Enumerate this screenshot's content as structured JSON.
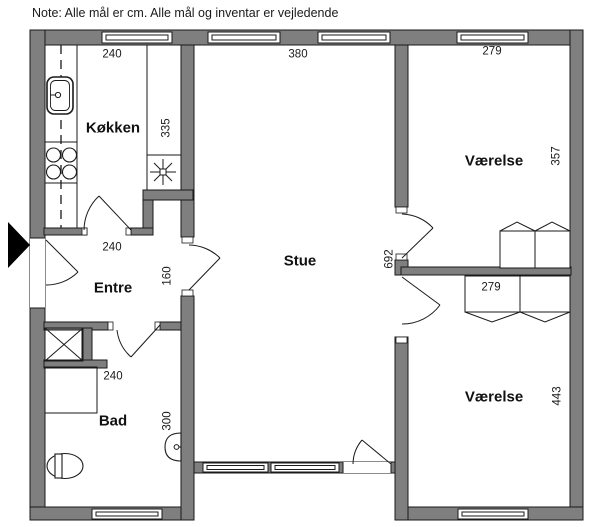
{
  "note": "Note: Alle mål er cm. Alle mål og inventar er vejledende",
  "rooms": {
    "koekken": {
      "label": "Køkken",
      "width_cm": "240",
      "depth_cm": "335"
    },
    "stue": {
      "label": "Stue",
      "width_cm": "380",
      "depth_cm": "692"
    },
    "vaerelse_top": {
      "label": "Værelse",
      "width_cm": "279",
      "depth_cm": "357"
    },
    "vaerelse_bottom": {
      "label": "Værelse",
      "width_cm": "279",
      "depth_cm": "443"
    },
    "entre": {
      "label": "Entre",
      "width_cm": "240",
      "opening_cm": "160"
    },
    "bad": {
      "label": "Bad",
      "width_cm": "240",
      "depth_cm": "300"
    }
  },
  "fixtures": [
    "kitchen-sink",
    "stove",
    "extractor-fan",
    "shower",
    "washing-machine",
    "toilet",
    "hand-basin",
    "wardrobe",
    "entrance-arrow"
  ],
  "colors": {
    "wall_fill": "#7f7f7f",
    "line": "#1a1a1a",
    "background": "#ffffff"
  }
}
